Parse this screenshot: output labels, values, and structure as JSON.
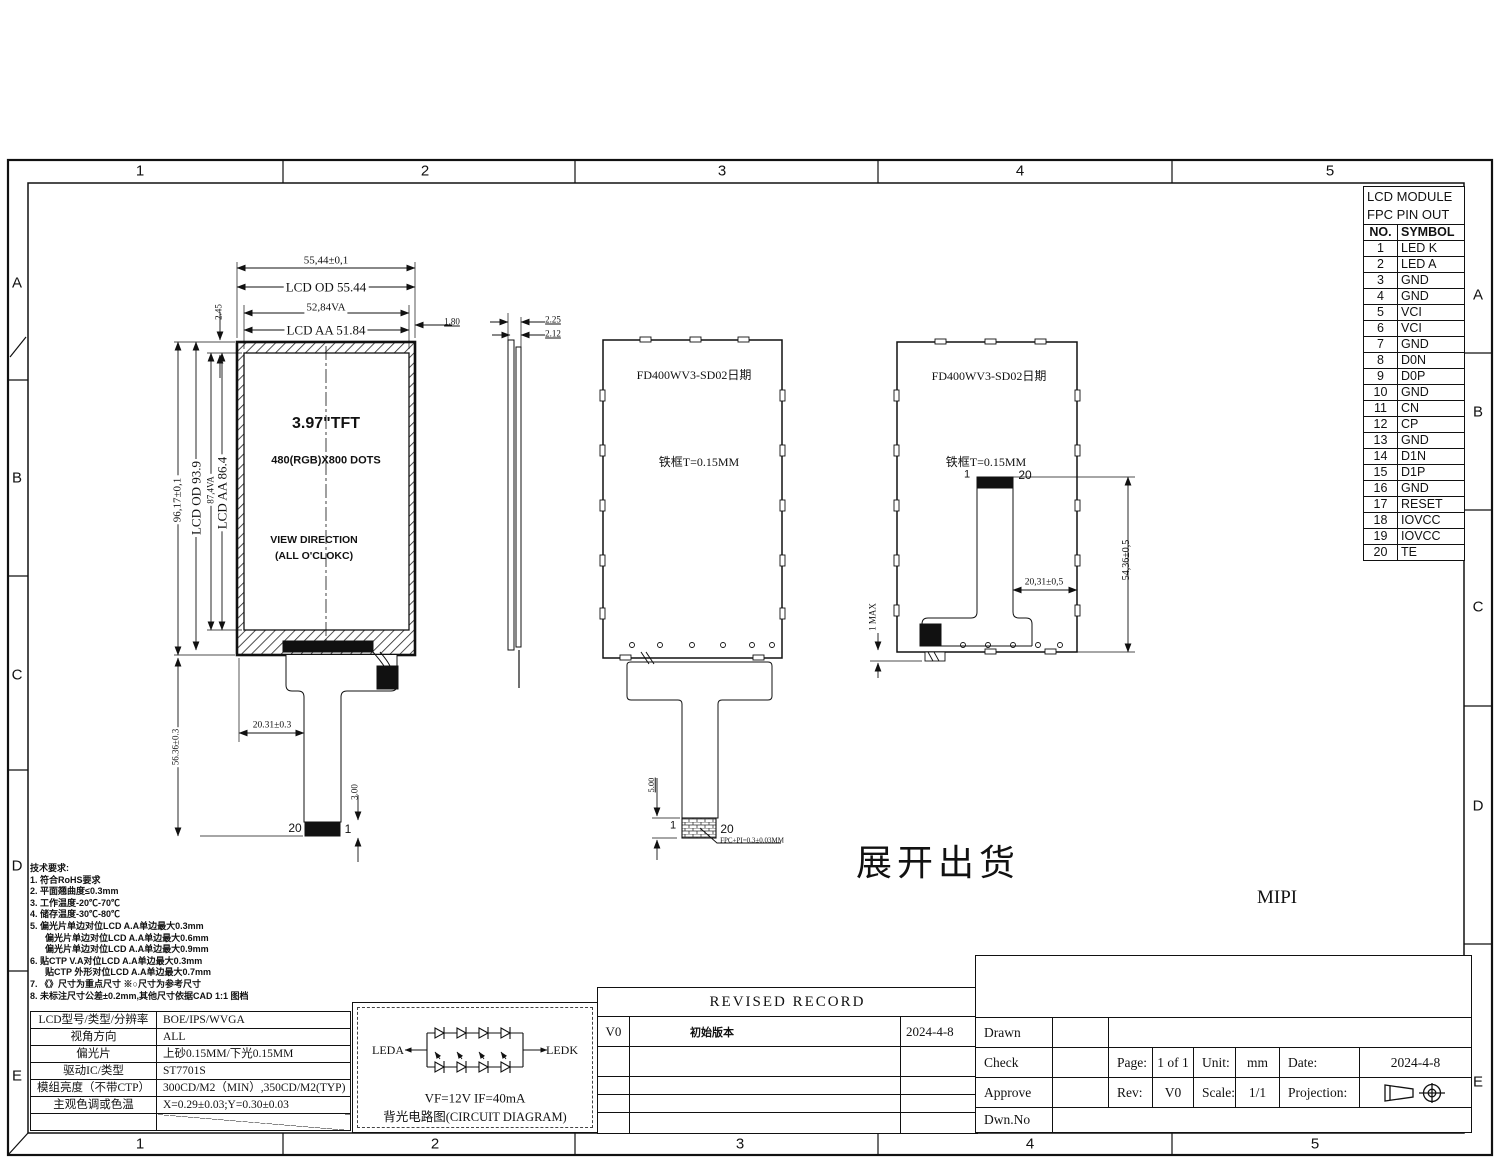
{
  "frame": {
    "cols": [
      "1",
      "2",
      "3",
      "4",
      "5"
    ],
    "rows": [
      "A",
      "B",
      "C",
      "D",
      "E"
    ]
  },
  "pin_table": {
    "title_line1": "LCD MODULE",
    "title_line2": "FPC PIN OUT",
    "col_no": "NO.",
    "col_symbol": "SYMBOL",
    "rows": [
      {
        "no": "1",
        "symbol": "LED K"
      },
      {
        "no": "2",
        "symbol": "LED A"
      },
      {
        "no": "3",
        "symbol": "GND"
      },
      {
        "no": "4",
        "symbol": "GND"
      },
      {
        "no": "5",
        "symbol": "VCI"
      },
      {
        "no": "6",
        "symbol": "VCI"
      },
      {
        "no": "7",
        "symbol": "GND"
      },
      {
        "no": "8",
        "symbol": "D0N"
      },
      {
        "no": "9",
        "symbol": "D0P"
      },
      {
        "no": "10",
        "symbol": "GND"
      },
      {
        "no": "11",
        "symbol": "CN"
      },
      {
        "no": "12",
        "symbol": "CP"
      },
      {
        "no": "13",
        "symbol": "GND"
      },
      {
        "no": "14",
        "symbol": "D1N"
      },
      {
        "no": "15",
        "symbol": "D1P"
      },
      {
        "no": "16",
        "symbol": "GND"
      },
      {
        "no": "17",
        "symbol": "RESET"
      },
      {
        "no": "18",
        "symbol": "IOVCC"
      },
      {
        "no": "19",
        "symbol": "IOVCC"
      },
      {
        "no": "20",
        "symbol": "TE"
      }
    ]
  },
  "front_view": {
    "size": "3.97\"TFT",
    "dots": "480(RGB)X800 DOTS",
    "view_dir1": "VIEW DIRECTION",
    "view_dir2": "(ALL O'CLOKC)",
    "pin20": "20",
    "pin1": "1",
    "dims": {
      "od_w_tol": "55,44±0,1",
      "od_w": "LCD OD 55.44",
      "va_w": "52,84VA",
      "aa_w": "LCD AA 51.84",
      "right_gap": "1.80",
      "top_gap": "2.45",
      "od_h_tol": "96,17±0,1",
      "od_h": "LCD OD 93.9",
      "va_h": "87,4VA",
      "aa_h": "LCD AA 86.4",
      "fpc_len": "56.36±0.3",
      "fpc_x": "20.31±0.3",
      "conn_h": "3.00"
    }
  },
  "side_view": {
    "dims": {
      "t1": "2.25",
      "t2": "2.12"
    }
  },
  "rear_view": {
    "part_no": "FD400WV3-SD02日期",
    "frame_note": "铁框T=0.15MM",
    "pin1": "1",
    "pin20": "20",
    "dims": {
      "tail": "5.00",
      "fpc_note": "FPC+PI=0.3±0.03MM"
    }
  },
  "folded_view": {
    "part_no": "FD400WV3-SD02日期",
    "frame_note": "铁框T=0.15MM",
    "pin1": "1",
    "pin20": "20",
    "dims": {
      "offset": "20,31±0,5",
      "height": "54,36±0,5",
      "max": "1 MAX"
    }
  },
  "annotations": {
    "shipping": "展开出货",
    "interface": "MIPI"
  },
  "notes": {
    "heading": "技术要求:",
    "items": [
      "1. 符合RoHS要求",
      "2. 平面翘曲度≤0.3mm",
      "3. 工作温度-20℃-70℃",
      "4. 储存温度-30℃-80℃",
      "5. 偏光片单边对位LCD A.A单边最大0.3mm",
      "偏光片单边对位LCD A.A单边最大0.6mm",
      "偏光片单边对位LCD A.A单边最大0.9mm",
      "6. 贴CTP V.A对位LCD A.A单边最大0.3mm",
      "贴CTP 外形对位LCD A.A单边最大0.7mm",
      "7. 《》尺寸为重点尺寸 ※○尺寸为参考尺寸",
      "8. 未标注尺寸公差±0.2mm,其他尺寸依据CAD 1:1 图档"
    ]
  },
  "spec_table": {
    "rows": [
      {
        "label": "LCD型号/类型/分辨率",
        "value": "BOE/IPS/WVGA"
      },
      {
        "label": "视角方向",
        "value": "ALL"
      },
      {
        "label": "偏光片",
        "value": "上砂0.15MM/下光0.15MM"
      },
      {
        "label": "驱动IC/类型",
        "value": "ST7701S"
      },
      {
        "label": "模组亮度（不带CTP）",
        "value": "300CD/M2（MIN）,350CD/M2(TYP)"
      },
      {
        "label": "主观色调或色温",
        "value": "X=0.29±0.03;Y=0.30±0.03"
      }
    ]
  },
  "circuit": {
    "led_a": "LEDA",
    "led_k": "LEDK",
    "spec": "VF=12V   IF=40mA",
    "caption": "背光电路图(CIRCUIT DIAGRAM)"
  },
  "revised_record": {
    "title": "REVISED RECORD",
    "version": "V0",
    "description": "初始版本",
    "date": "2024-4-8"
  },
  "title_block": {
    "drawn": "Drawn",
    "check": "Check",
    "approve": "Approve",
    "dwn_no": "Dwn.No",
    "page_label": "Page:",
    "page_value": "1 of 1",
    "unit_label": "Unit:",
    "unit_value": "mm",
    "date_label": "Date:",
    "date_value": "2024-4-8",
    "rev_label": "Rev:",
    "rev_value": "V0",
    "scale_label": "Scale:",
    "scale_value": "1/1",
    "projection_label": "Projection:"
  }
}
